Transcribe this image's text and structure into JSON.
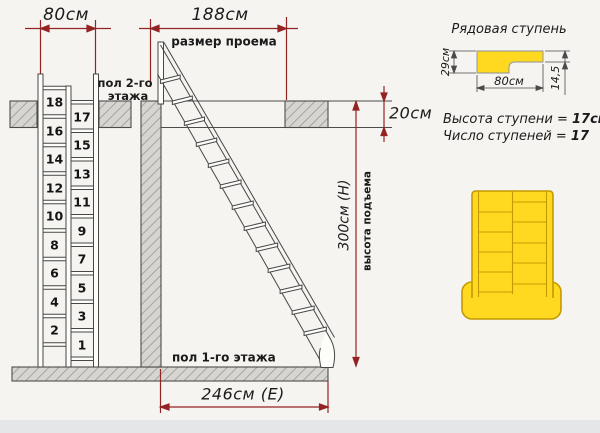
{
  "main_diagram": {
    "dim_ladder_opening_width": "80см",
    "dim_opening_length": "188см",
    "opening_caption": "размер проема",
    "floor2_caption_line1": "пол 2-го",
    "floor2_caption_line2": "этажа",
    "dim_slab_thickness": "20см",
    "dim_rise_height": "300см (Н)",
    "rise_caption": "высота подъема",
    "floor1_caption": "пол 1-го этажа",
    "dim_run_length": "246см (Е)",
    "ladder_step_numbers_left": [
      "18",
      "16",
      "14",
      "12",
      "10",
      "8",
      "6",
      "4",
      "2"
    ],
    "ladder_step_numbers_right": [
      "17",
      "15",
      "13",
      "11",
      "9",
      "7",
      "5",
      "3",
      "1"
    ]
  },
  "step_detail": {
    "title": "Рядовая ступень",
    "dim_depth": "29см",
    "dim_width": "80см",
    "dim_nose": "14,5"
  },
  "specs": {
    "step_height_label": "Высота ступени = ",
    "step_height_value": "17см",
    "step_count_label": "Число ступеней = ",
    "step_count_value": "17"
  },
  "colors": {
    "dimension_red": "#942323",
    "step_yellow": "#ffd91f",
    "step_outline": "#c49a00"
  }
}
